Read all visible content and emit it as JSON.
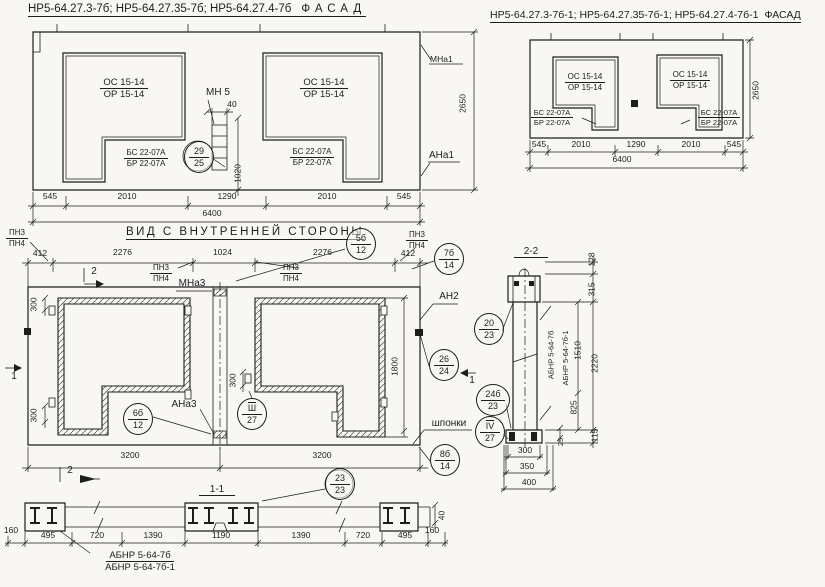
{
  "colors": {
    "paper": "#f8f7f4",
    "ink": "#1d1d1d"
  },
  "facade_left": {
    "title": "НР5-64.27.3-7б; НР5-64.27.35-7б; НР5-64.27.4-7б",
    "fasad": "ФАСАД",
    "win_top": "ОС 15-14",
    "win_bot": "ОР 15-14",
    "sill_top": "БС 22-07А",
    "sill_bot": "БР 22-07А",
    "mn5": "МН 5",
    "dim40": "40",
    "dim1020": "1020",
    "callout_29": {
      "a": "29",
      "b": "25"
    },
    "mna1": "МНа1",
    "ana1": "АНа1",
    "dim2650": "2650",
    "dims": [
      "545",
      "2010",
      "1290",
      "2010",
      "545"
    ],
    "dim6400": "6400"
  },
  "facade_right": {
    "title": "НР5-64.27.3-7б-1; НР5-64.27.35-7б-1; НР5-64.27.4-7б-1",
    "fasad": "ФАСАД",
    "win_top": "ОС 15-14",
    "win_bot": "ОР 15-14",
    "sill_top": "БС 22-07А",
    "sill_bot": "БР 22-07А",
    "dims": [
      "545",
      "2010",
      "1290",
      "2010",
      "545"
    ],
    "dim6400": "6400",
    "dim2650": "2650"
  },
  "inner": {
    "title": "ВИД С ВНУТРЕННЕЙ СТОРОНЫ",
    "pn3": "ПН3",
    "pn4": "ПН4",
    "dim412": "412",
    "dim2276": "2276",
    "dim1024": "1024",
    "callout_5b": {
      "a": "5б",
      "b": "12"
    },
    "callout_7b": {
      "a": "7б",
      "b": "14"
    },
    "mna3": "МНа3",
    "ana3": "АНа3",
    "an2": "АН2",
    "callout_6b": {
      "a": "6б",
      "b": "12"
    },
    "callout_sh": {
      "a": "Ш",
      "b": "27"
    },
    "callout_26": {
      "a": "26",
      "b": "24"
    },
    "callout_8b": {
      "a": "8б",
      "b": "14"
    },
    "callout_20": {
      "a": "20",
      "b": "23"
    },
    "callout_24b": {
      "a": "24б",
      "b": "23"
    },
    "callout_iv": {
      "a": "IV",
      "b": "27"
    },
    "shponki": "шпонки",
    "dim300": "300",
    "dim1800": "1800",
    "dim3200": "3200",
    "mark1": "1",
    "mark2": "2"
  },
  "section22": {
    "title": "2-2",
    "label1": "АБНР 5-64-7б",
    "label2": "АБНР 5-64-7б-1",
    "dim128": "128",
    "dim315": "315",
    "dim2220": "2220",
    "dim115": "115",
    "dim1510": "1510",
    "dim825": "825",
    "dim25": "25",
    "dim300": "300",
    "dim350": "350",
    "dim400": "400"
  },
  "section11": {
    "title": "1-1",
    "callout_23": {
      "a": "23",
      "b": "23"
    },
    "dims": [
      "495",
      "720",
      "1390",
      "1190",
      "1390",
      "720",
      "495"
    ],
    "dim160": "160",
    "dim40": "40",
    "label1": "АБНР 5-64-7б",
    "label2": "АБНР 5-64-7б-1"
  }
}
